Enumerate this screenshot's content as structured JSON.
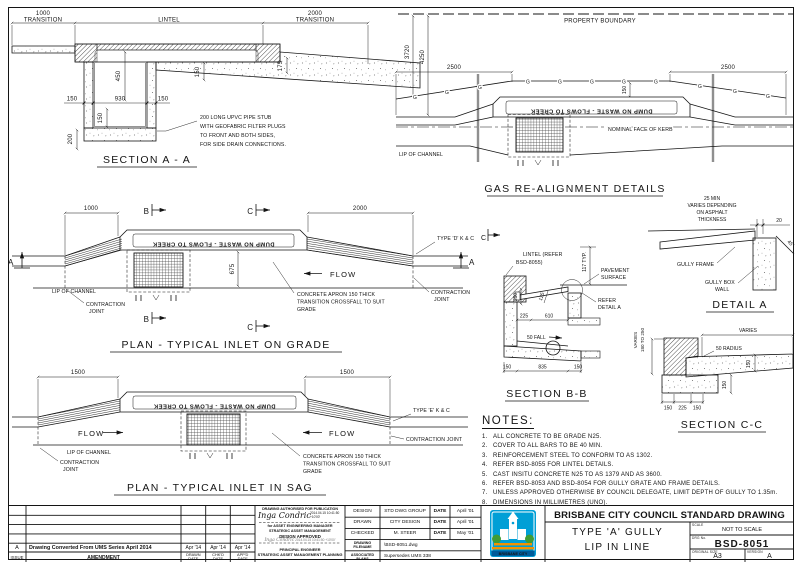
{
  "sheet": {
    "colors": {
      "line": "#141414",
      "paper": "#ffffff",
      "logo_blue": "#009fd6",
      "logo_band": "#005b99",
      "logo_green": "#3f9c35",
      "logo_orange": "#f39200"
    }
  },
  "section_a_a": {
    "title": "SECTION A - A",
    "dim_1000": "1000",
    "transition_l": "TRANSITION",
    "lintel": "LINTEL",
    "dim_2000": "2000",
    "transition_r": "TRANSITION",
    "dim_450": "450",
    "dim_175": "175",
    "dim_150_slab": "150",
    "dim_150_l": "150",
    "dim_930": "930",
    "dim_150_r": "150",
    "dim_150_floor": "150",
    "dim_200": "200",
    "note_1": "200 LONG UPVC PIPE STUB",
    "note_2": "WITH GEOFABRIC FILTER PLUGS",
    "note_3": "TO FRONT AND BOTH SIDES,",
    "note_4": "FOR SIDE DRAIN CONNECTIONS."
  },
  "gas_realignment": {
    "title": "GAS RE-ALIGNMENT DETAILS",
    "property_boundary": "PROPERTY BOUNDARY",
    "dim_3720": "3720",
    "dim_4250": "4250",
    "dim_2500_l": "2500",
    "dim_2500_r": "2500",
    "dim_150": "150",
    "gas_marker": "G",
    "lintel_text": "DUMP NO WASTE - FLOWS TO CREEK",
    "nominal_face_of_kerb": "NOMINAL FACE OF KERB",
    "lip_of_channel": "LIP OF CHANNEL"
  },
  "plan_on_grade": {
    "title": "PLAN - TYPICAL INLET ON GRADE",
    "dim_1000": "1000",
    "dim_2000": "2000",
    "dim_675": "675",
    "marker_a": "A",
    "marker_b": "B",
    "marker_c": "C",
    "lintel_text": "DUMP NO WASTE - FLOWS TO CREEK",
    "flow": "FLOW",
    "lip_of_channel": "LIP OF CHANNEL",
    "contraction_1": "CONTRACTION",
    "contraction_2": "JOINT",
    "type_kc": "TYPE 'D' K & C",
    "apron_1": "CONCRETE APRON 150 THICK",
    "apron_2": "TRANSITION CROSSFALL TO SUIT",
    "apron_3": "GRADE"
  },
  "plan_in_sag": {
    "title": "PLAN - TYPICAL INLET IN SAG",
    "dim_1500_l": "1500",
    "dim_1500_r": "1500",
    "lintel_text": "DUMP NO WASTE - FLOWS TO CREEK",
    "flow": "FLOW",
    "lip_of_channel": "LIP OF CHANNEL",
    "contraction_1": "CONTRACTION",
    "contraction_2": "JOINT",
    "contraction_joint": "CONTRACTION JOINT",
    "type_kc": "TYPE 'E' K & C",
    "apron_1": "CONCRETE APRON 150 THICK",
    "apron_2": "TRANSITION CROSSFALL TO SUIT",
    "apron_3": "GRADE"
  },
  "section_b_b": {
    "title": "SECTION B-B",
    "marker_c": "C",
    "lintel_ref_1": "LINTEL (REFER",
    "lintel_ref_2": "BSD-8055)",
    "dim_117": "117 TYP.",
    "pavement_1": "PAVEMENT",
    "pavement_2": "SURFACE",
    "refer_1": "REFER",
    "refer_2": "DETAIL A",
    "dim_250": "250",
    "dim_125": "125",
    "dim_225": "225",
    "dim_610": "610",
    "fall": "50 FALL",
    "dim_150_l": "150",
    "dim_835": "835",
    "dim_150_r": "150"
  },
  "detail_a": {
    "title": "DETAIL A",
    "note_1": "25 MIN",
    "note_2": "VARIES DEPENDING",
    "note_3": "ON ASPHALT",
    "note_4": "THICKNESS",
    "dim_20": "20",
    "angle": "45°",
    "gully_frame": "GULLY FRAME",
    "gully_box_1": "GULLY BOX",
    "gully_box_2": "WALL"
  },
  "section_c_c": {
    "title": "SECTION C-C",
    "varies_top": "VARIES",
    "varies_1": "VARIES",
    "varies_2": "180 TO 250",
    "radius": "50 RADIUS",
    "dim_150_base": "150",
    "dim_150_apron": "150",
    "dim_150_bl": "150",
    "dim_225": "225",
    "dim_150_br": "150"
  },
  "notes": {
    "title": "NOTES:",
    "items": [
      {
        "n": "1.",
        "text": "ALL CONCRETE TO BE GRADE N25."
      },
      {
        "n": "2.",
        "text": "COVER TO ALL BARS TO BE 40 MIN."
      },
      {
        "n": "3.",
        "text": "REINFORCEMENT STEEL TO CONFORM TO AS 1302."
      },
      {
        "n": "4.",
        "text": "REFER BSD-8055 FOR LINTEL DETAILS."
      },
      {
        "n": "5.",
        "text": "CAST INSITU CONCRETE N25 TO AS 1379 AND AS 3600."
      },
      {
        "n": "6.",
        "text": "REFER BSD-8053 AND BSD-8054 FOR GULLY GRATE AND FRAME DETAILS."
      },
      {
        "n": "7.",
        "text": "UNLESS APPROVED OTHERWISE BY COUNCIL DELEGATE, LIMIT DEPTH OF GULLY TO 1.35m."
      },
      {
        "n": "8.",
        "text": "DIMENSIONS IN MILLIMETRES (UNO)."
      }
    ]
  },
  "titleblock": {
    "amendments": {
      "headers": {
        "issue": "ISSUE",
        "amendment": "AMENDMENT",
        "drawn_1": "DRAWN",
        "drawn_2": "DATE",
        "chkd_1": "CHK'D",
        "chkd_2": "DATE",
        "appd_1": "APP'D",
        "appd_2": "DATE"
      },
      "rows": [
        {
          "issue": "A",
          "amendment": "Drawing Converted From UMS Series April 2014",
          "drawn": "Apr '14",
          "chkd": "Apr '14",
          "appd": "Apr '14"
        }
      ]
    },
    "signatures": {
      "authorised": "DRAWING AUTHORISED FOR PUBLICATION",
      "sig_name": "Inga Condric",
      "sig_ts_1": "2014.04.15 10:41:50",
      "sig_ts_2": "+10'00'",
      "for_role_1": "for ASSET ENGINEERING MANAGER",
      "for_role_2": "STRATEGIC ASSET MANAGEMENT",
      "design_approved": "DESIGN APPROVED",
      "sig2_name": "Inga Condric",
      "sig2_ts": "2014.04.15 10:41:50 +10'00'",
      "role2_1": "PRINCIPAL ENGINEER",
      "role2_2": "STRATEGIC ASSET MANAGEMENT PLANNING"
    },
    "design_table": {
      "rows": [
        {
          "label": "DESIGN",
          "value": "STD DWG GROUP",
          "date_label": "DATE",
          "date": "April '01"
        },
        {
          "label": "DRAWN",
          "value": "CITY DESIGN",
          "date_label": "DATE",
          "date": "April '01"
        },
        {
          "label": "CHECKED",
          "value": "M. STEER",
          "date_label": "DATE",
          "date": "May '01"
        }
      ],
      "filename_label_1": "DRAWING",
      "filename_label_2": "FILENAME",
      "filename": "\\BSD-8051.dwg",
      "assoc_label_1": "ASSOCIATED",
      "assoc_label_2": "PLANS",
      "assoc": "Supersedes UMS 338"
    },
    "brand": {
      "org": "BRISBANE CITY COUNCIL STANDARD DRAWING",
      "title_1": "TYPE 'A' GULLY",
      "title_2": "LIP IN LINE",
      "scale_label": "SCALE",
      "scale": "NOT TO SCALE",
      "drg_label": "DRG No.",
      "drg_no": "BSD-8051",
      "size_label": "ORIGINAL SIZE",
      "size": "A3",
      "version_label": "VERSION",
      "version": "A",
      "logo_text": "BRISBANE CITY"
    }
  }
}
